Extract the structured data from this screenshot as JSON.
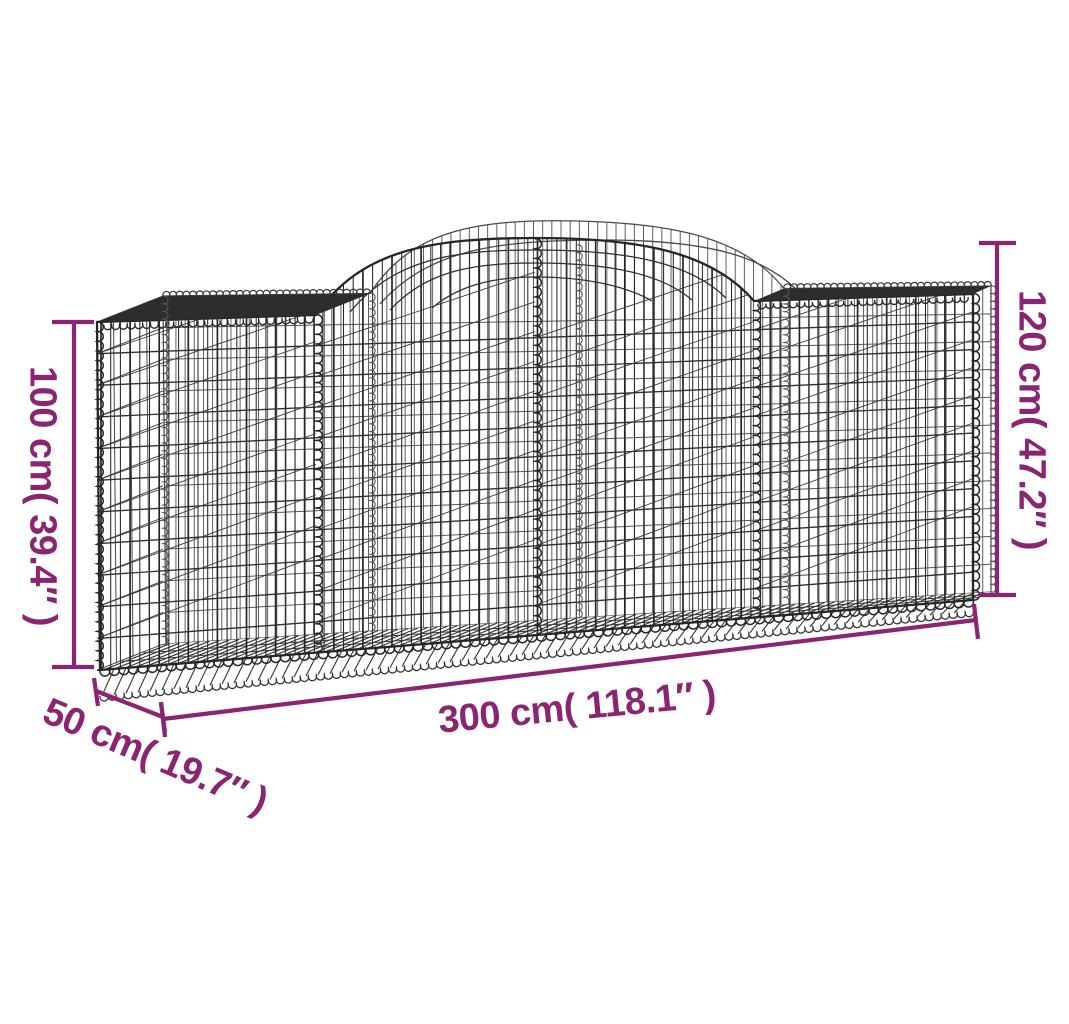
{
  "illustration": {
    "alt": "Arched gabion basket wire-mesh drawing with measurement lines"
  },
  "dimensions": {
    "height_left": {
      "label": "100 cm( 39.4″ )"
    },
    "height_right": {
      "label": "120 cm( 47.2″ )"
    },
    "length": {
      "label": "300 cm( 118.1″ )"
    },
    "depth": {
      "label": "50 cm( 19.7″ )"
    }
  },
  "colors": {
    "dimension_accent": "#8B2471",
    "wire_dark": "#262626",
    "wire_mid": "#3d3d3d",
    "wire_light": "#565656",
    "band": "#2d2d2d",
    "background": "#FFFFFF"
  }
}
